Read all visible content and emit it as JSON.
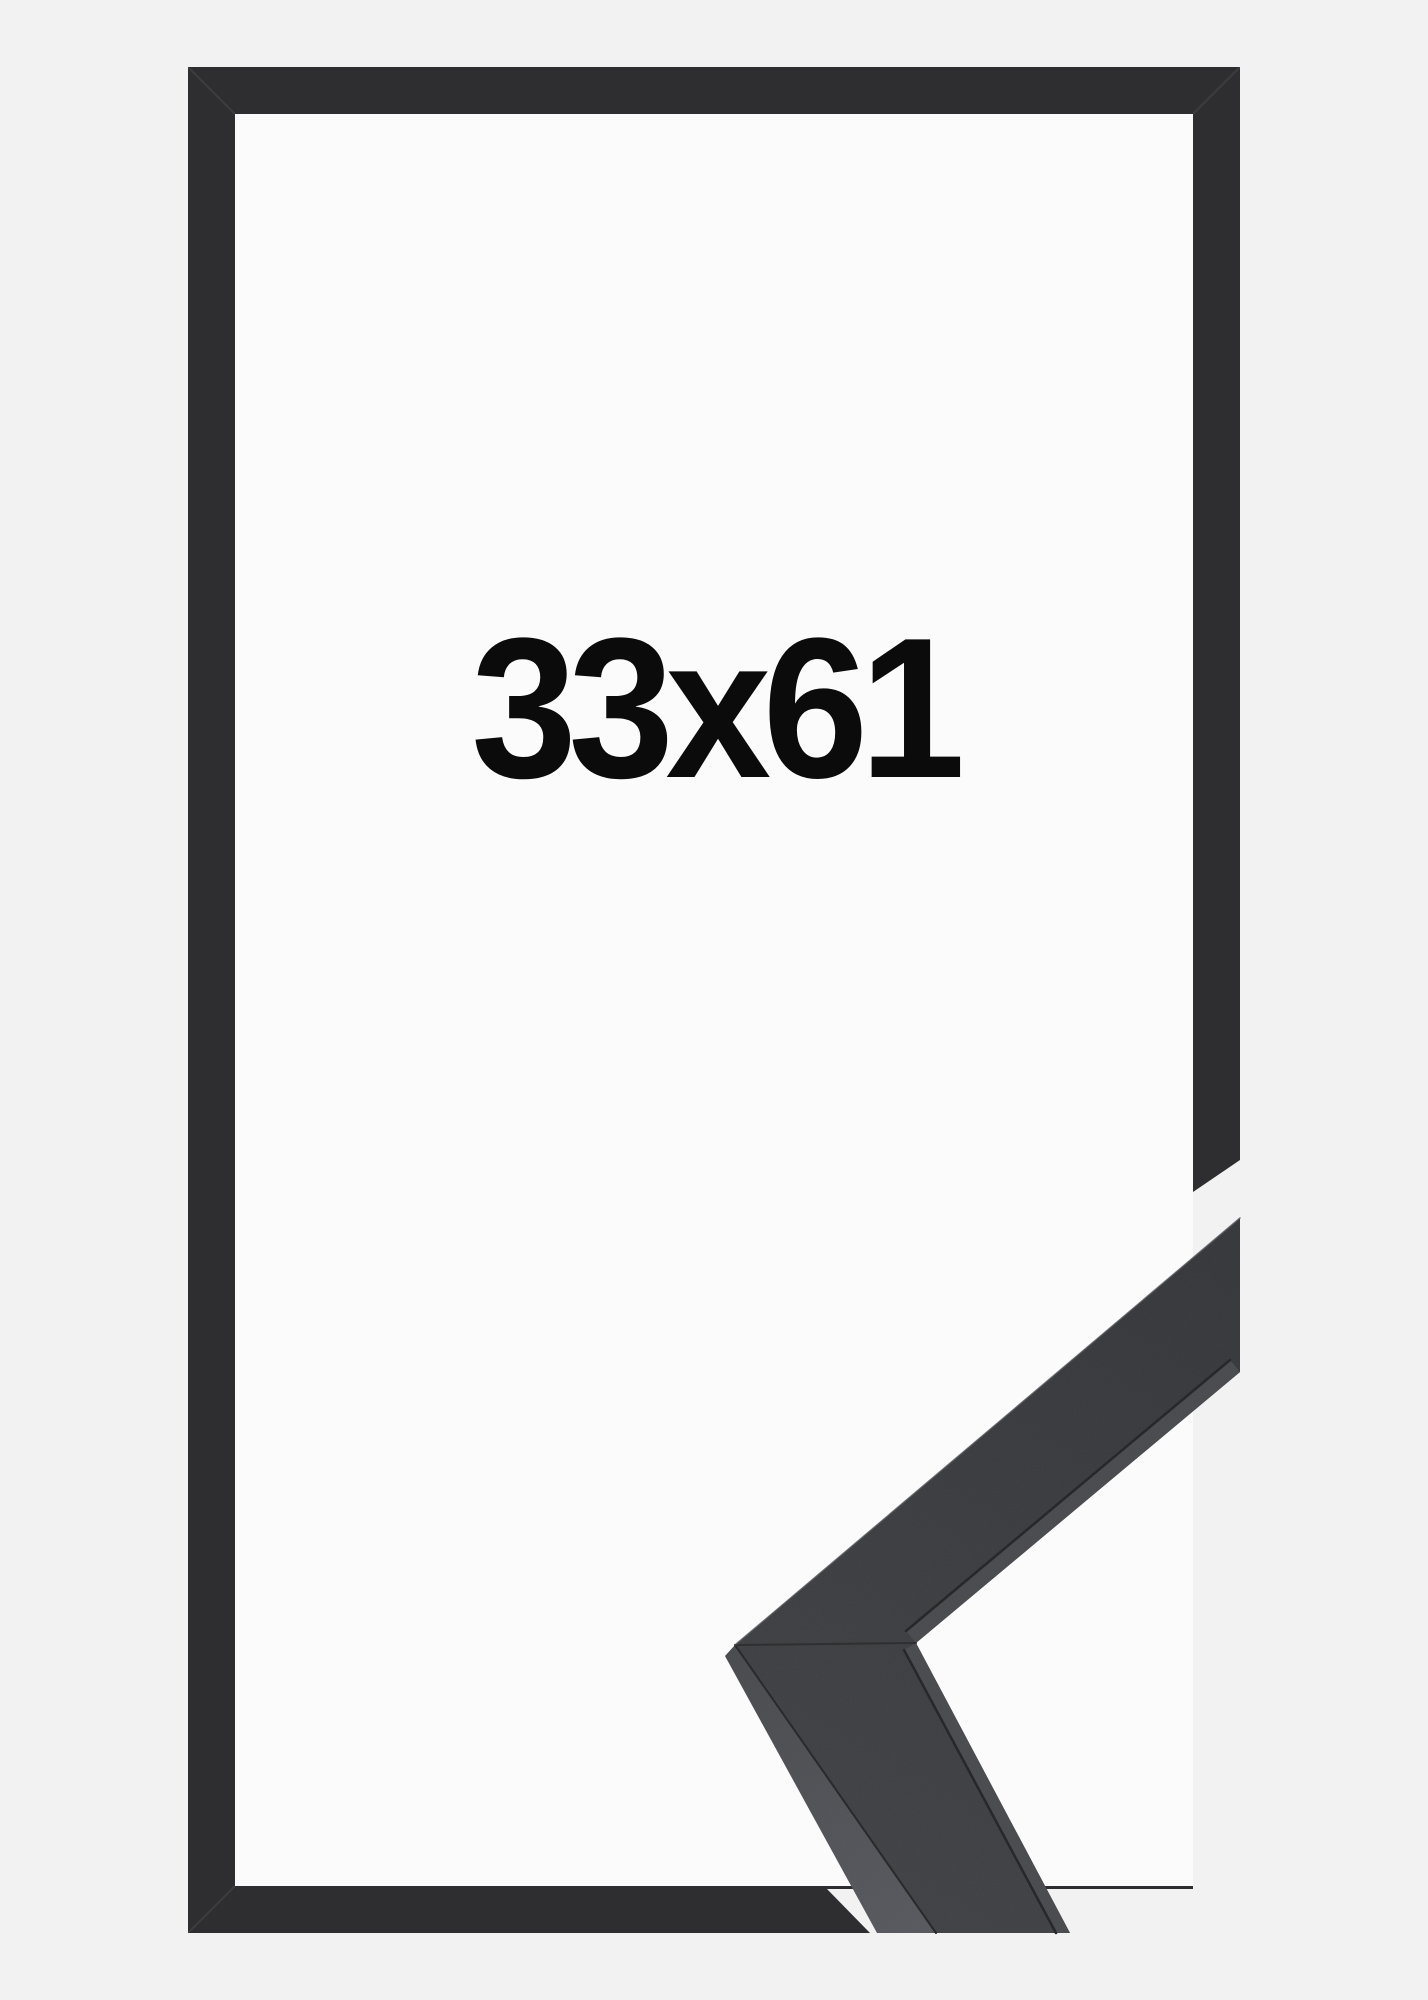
{
  "frame_product": {
    "size_label": "33x61"
  },
  "colors": {
    "background": "#f2f2f3",
    "inner_area": "#fbfbfc",
    "frame_bar": "#2e2e30",
    "moulding_top_start": "#3e3f42",
    "moulding_top_end": "#343538",
    "moulding_side_start": "#47484c",
    "moulding_side_end": "#55565b",
    "moulding_lip": "#47484c",
    "seam": "#232325",
    "edge_highlight": "#515257",
    "label_text": "#0b0b0c"
  }
}
